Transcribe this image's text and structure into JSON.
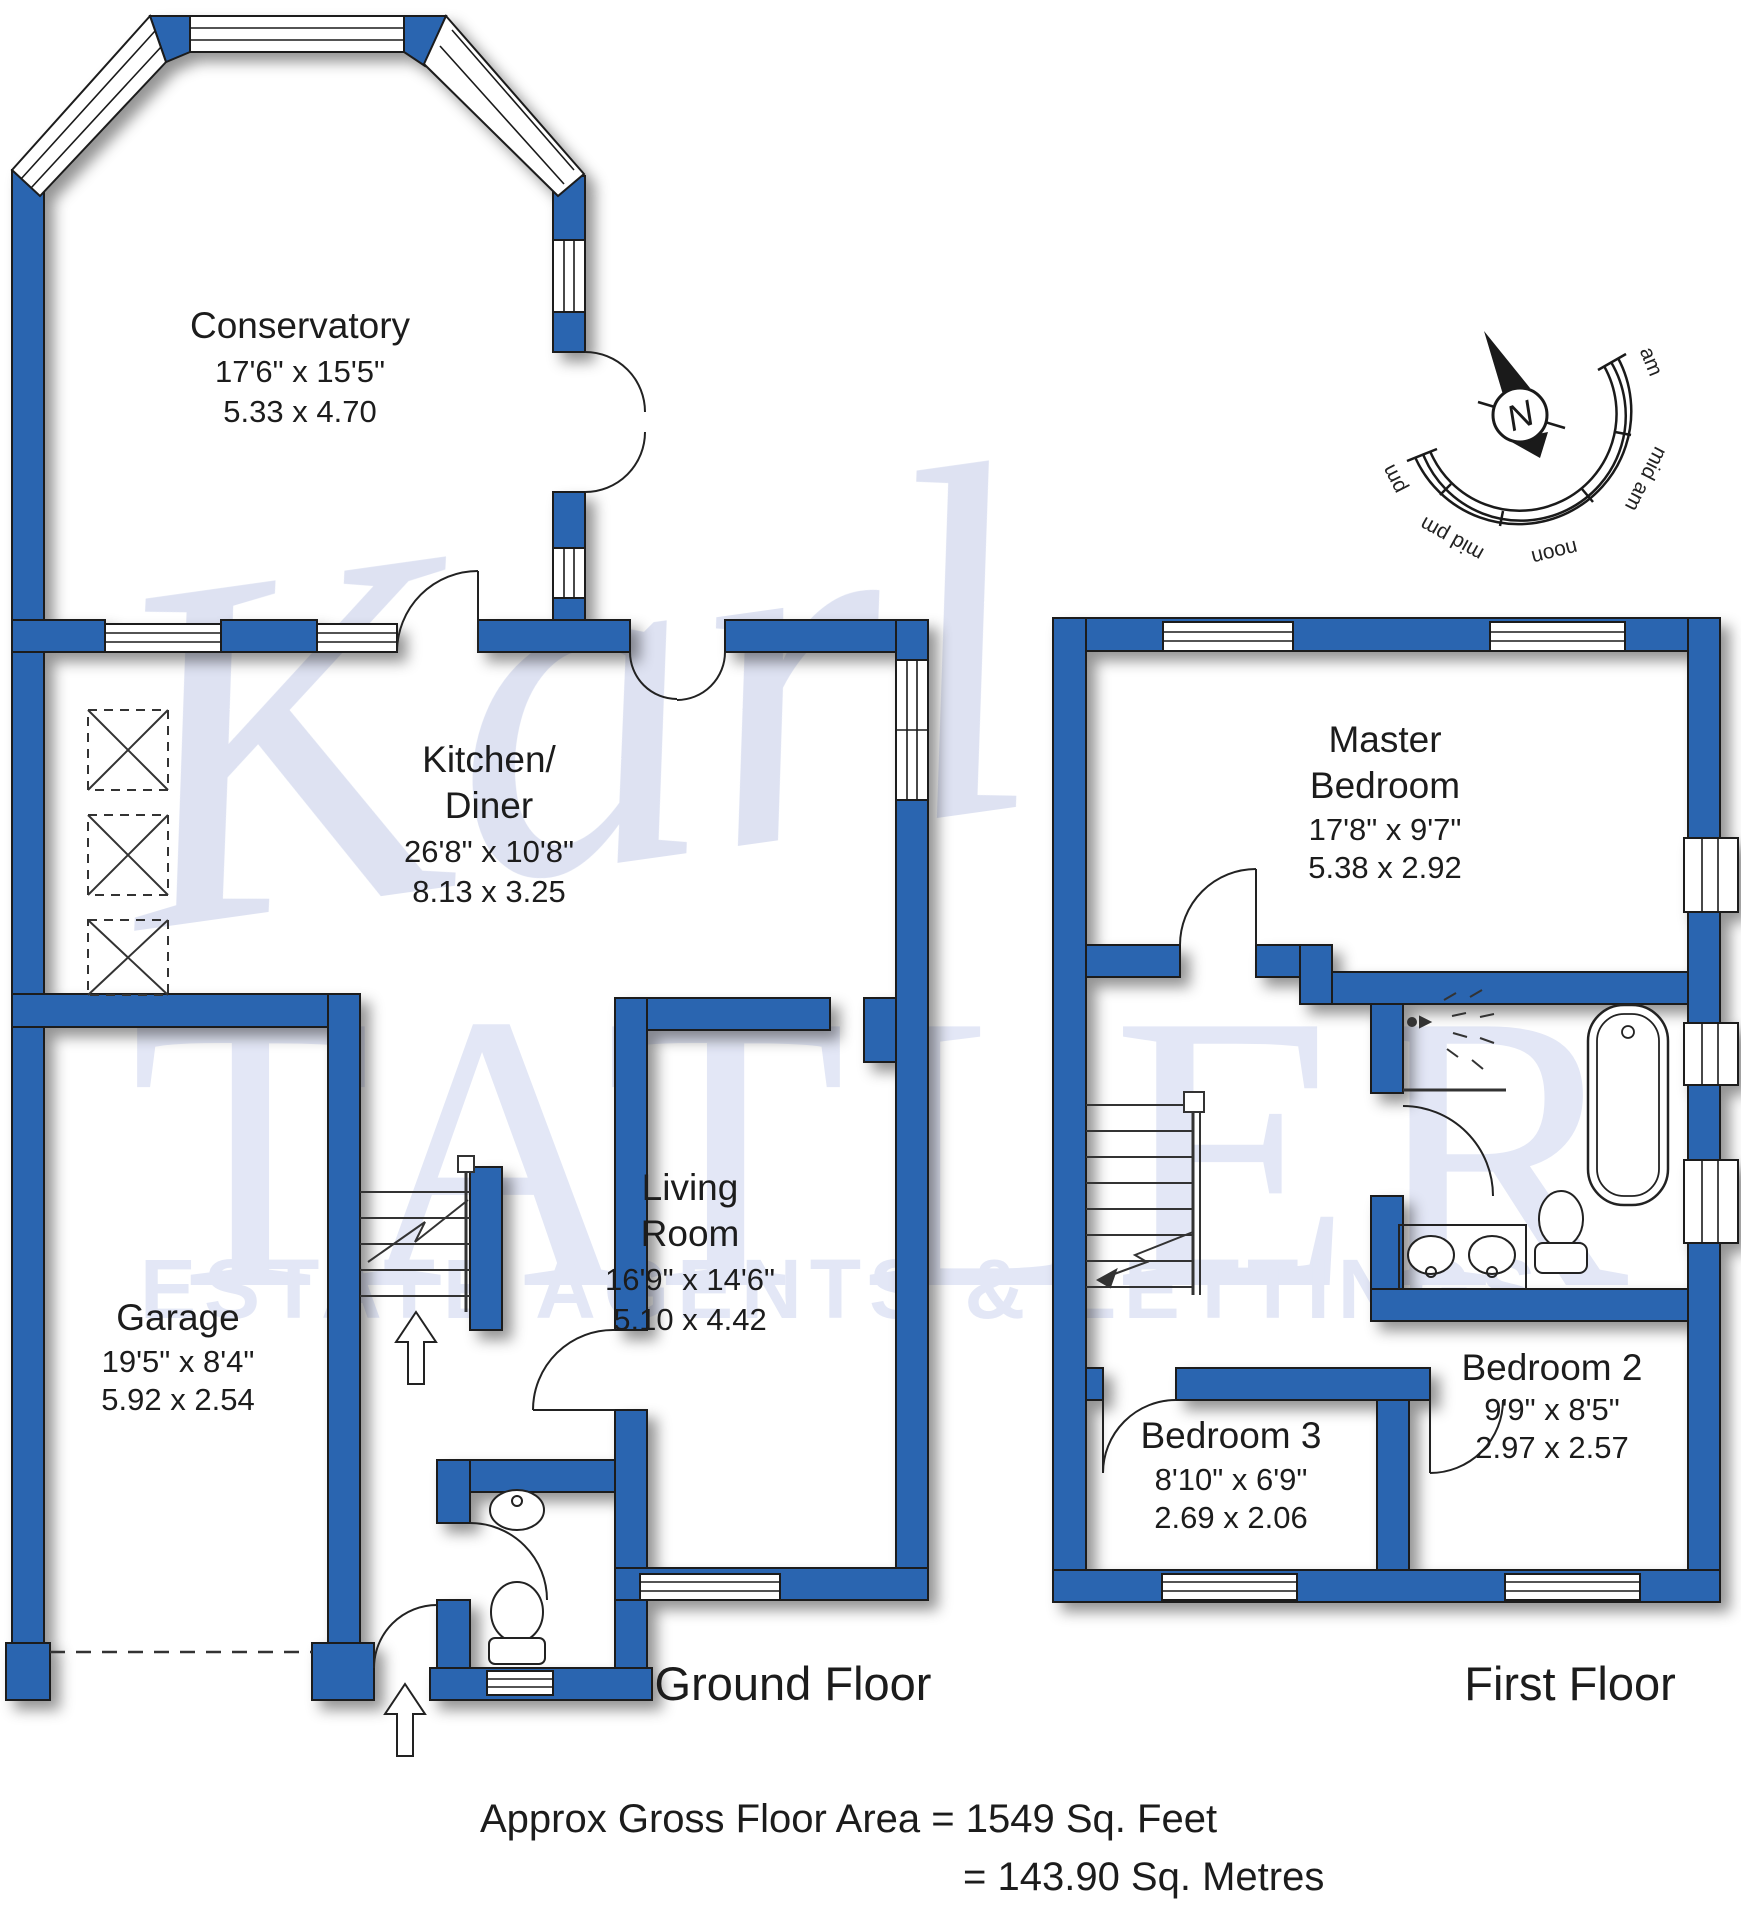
{
  "watermark": {
    "script": "Karl",
    "big": "TATLER",
    "sub": "ESTATE AGENTS & LETTINGS"
  },
  "compass": {
    "north": "N",
    "arc_labels": [
      "am",
      "mid am",
      "noon",
      "mid pm",
      "pm"
    ]
  },
  "floors": {
    "ground": {
      "label": "Ground Floor"
    },
    "first": {
      "label": "First Floor"
    }
  },
  "rooms": {
    "conservatory": {
      "name": "Conservatory",
      "imperial": "17'6\" x 15'5\"",
      "metric": "5.33  x  4.70"
    },
    "kitchen": {
      "name_line1": "Kitchen/",
      "name_line2": "Diner",
      "imperial": "26'8\" x 10'8\"",
      "metric": "8.13  x  3.25"
    },
    "living": {
      "name_line1": "Living",
      "name_line2": "Room",
      "imperial": "16'9\" x 14'6\"",
      "metric": "5.10  x  4.42"
    },
    "garage": {
      "name": "Garage",
      "imperial": "19'5\" x  8'4\"",
      "metric": "5.92  x  2.54"
    },
    "master": {
      "name_line1": "Master",
      "name_line2": "Bedroom",
      "imperial": "17'8\" x  9'7\"",
      "metric": "5.38  x  2.92"
    },
    "bedroom2": {
      "name": "Bedroom 2",
      "imperial": "9'9\"  x  8'5\"",
      "metric": "2.97  x  2.57"
    },
    "bedroom3": {
      "name": "Bedroom 3",
      "imperial": "8'10\" x  6'9\"",
      "metric": "2.69  x  2.06"
    }
  },
  "footer": {
    "line1": "Approx Gross Floor Area  =  1549  Sq. Feet",
    "line2": "=  143.90  Sq. Metres"
  },
  "colors": {
    "wall": "#2b65b0",
    "outline": "#1a1a1a",
    "watermark": "#ccd4ee",
    "text": "#1c1c1c"
  }
}
